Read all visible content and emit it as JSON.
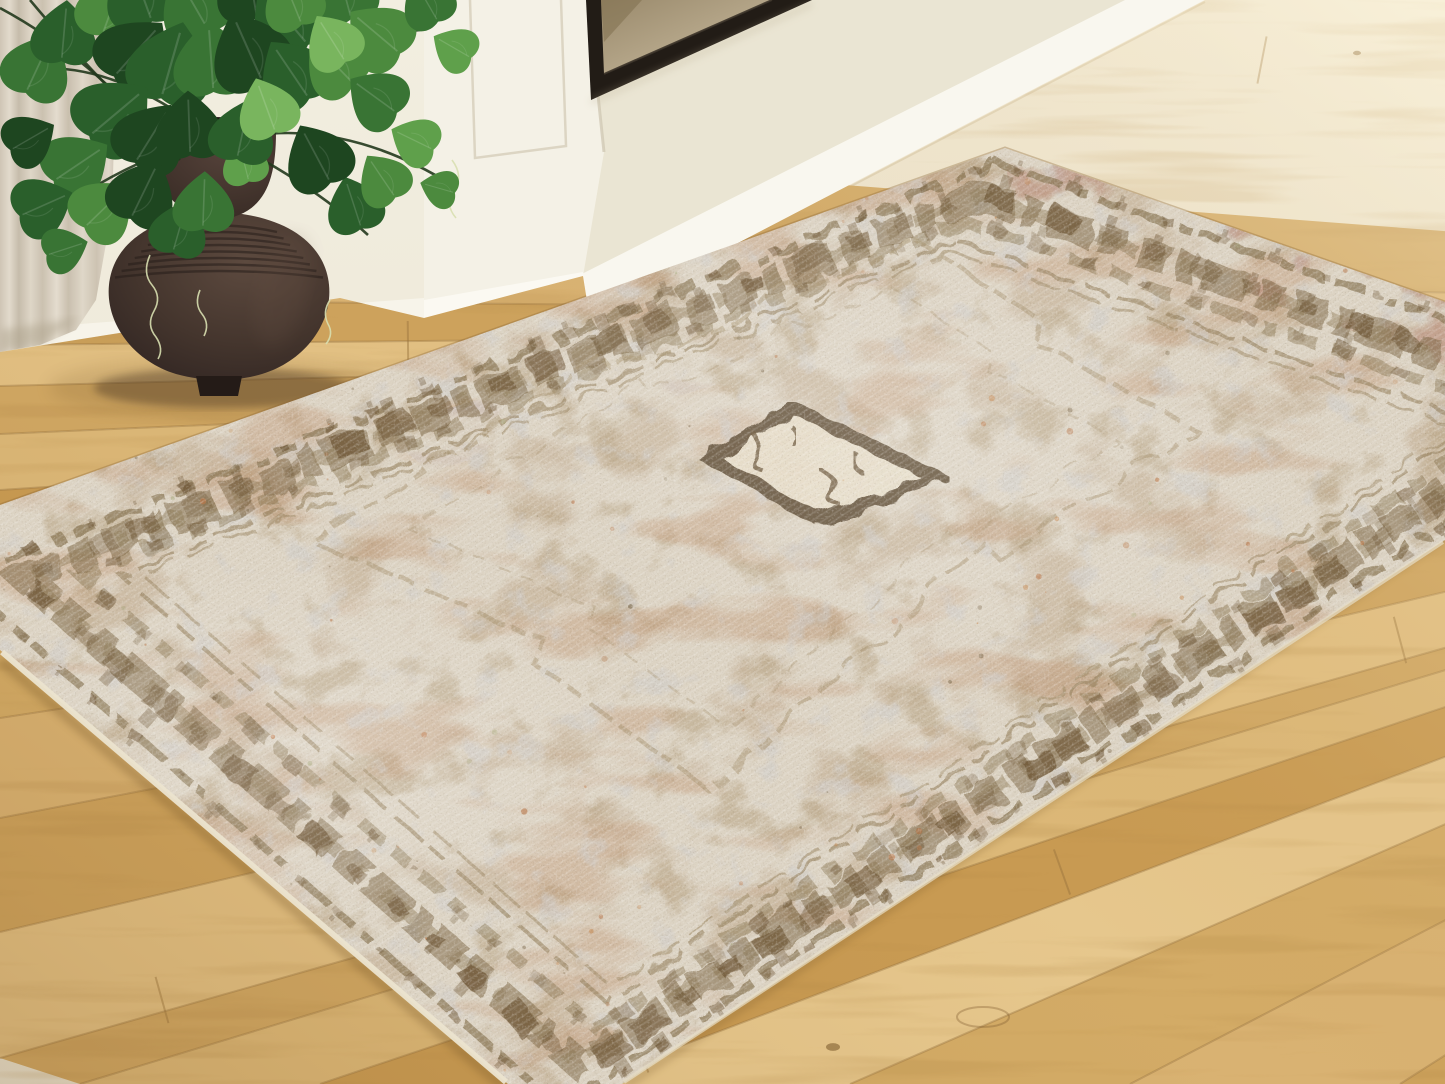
{
  "scene": {
    "kind": "room-photo",
    "subject": "distressed vintage medallion area rug on light oak hardwood floor",
    "props": [
      "white fireplace surround",
      "framed bronze artwork",
      "beige linen curtain",
      "dark brown gourd vase",
      "trailing pothos plant"
    ]
  },
  "palette": {
    "wallTop": "#f2eee0",
    "wallBottom": "#e9e3d1",
    "surround": "#eae5d3",
    "bandWhite": "#f9f7ef",
    "pillar": "#f4f1e6",
    "pillarEdge": "#d9d2bf",
    "baseboard": "#f7f4ea",
    "frame": "#221c16",
    "frameLip": "#3d352b",
    "canvasA": "#9a8a6c",
    "canvasB": "#b3a487",
    "canvasC": "#80704f",
    "curtainA": "#d9d0c1",
    "curtainB": "#c6bcab",
    "curtainC": "#e4dcce",
    "floorLight": "#e4c68c",
    "floorMid": "#d5ab66",
    "floorDark": "#c3924c",
    "seam": "#96713c",
    "knot": "#7c5a2e",
    "floorStreak": "#b08645",
    "shadow": "#6e4f23",
    "rugBase": "#dcd3c3",
    "rugTaupe": "#c7b49b",
    "rugTan": "#b5a07f",
    "rugRust": "#bb8a63",
    "rugGray": "#cfccc9",
    "rugPink": "#c09384",
    "rugLavender": "#cbc4c6",
    "borderDark": "#79643f",
    "borderMid": "#8d7956",
    "motif": "#6f5939",
    "lineThin": "#97825f",
    "fieldLine": "#a5906c",
    "medallionFill": "#e7ddc8",
    "medallionEdge": "#5f4d35",
    "medallionInk": "#6b5438",
    "binding": "#ece4cf",
    "vaseDark": "#372a24",
    "vaseMid": "#4a3a31",
    "vaseLight": "#5d4a3f",
    "vaseRib": "#271e19",
    "leafColors": [
      "#1e4620",
      "#2a5f2b",
      "#397434",
      "#4c8a3e",
      "#5fa04b",
      "#79b55e"
    ],
    "stem": "#22391d",
    "tendril": "#d8dfb0",
    "speckleRust": [
      "#bf7a4a",
      "#c78d58",
      "#b56f3f"
    ],
    "speckleSage": [
      "#9fa06f",
      "#b0b184"
    ],
    "speckleDark": "#6a5535"
  },
  "wall": {
    "floorBoundary": [
      [
        0,
        352
      ],
      [
        340,
        298
      ],
      [
        424,
        318
      ],
      [
        583,
        276
      ],
      [
        590,
        320
      ],
      [
        1205,
        0
      ]
    ],
    "surroundPoly": [
      [
        588,
        0
      ],
      [
        1128,
        0
      ],
      [
        560,
        285
      ],
      [
        583,
        276
      ],
      [
        604,
        152
      ]
    ],
    "bandPoly": [
      [
        560,
        285
      ],
      [
        1125,
        0
      ],
      [
        1205,
        0
      ],
      [
        590,
        320
      ]
    ],
    "leftBasePoly": [
      [
        0,
        330
      ],
      [
        424,
        298
      ],
      [
        424,
        318
      ],
      [
        0,
        352
      ]
    ],
    "pillarPoly": [
      [
        424,
        0
      ],
      [
        588,
        0
      ],
      [
        604,
        152
      ],
      [
        583,
        276
      ],
      [
        424,
        318
      ]
    ],
    "pillarBasePoly": [
      [
        424,
        300
      ],
      [
        583,
        272
      ],
      [
        586,
        286
      ],
      [
        424,
        322
      ]
    ],
    "panelLine": "M470,0 L475,158 L566,146 L561,0"
  },
  "artwork": {
    "framePoly": [
      [
        586,
        0
      ],
      [
        812,
        0
      ],
      [
        591,
        100
      ]
    ],
    "canvasPoly": [
      [
        601,
        0
      ],
      [
        772,
        0
      ],
      [
        604,
        74
      ]
    ],
    "shadePoly": [
      [
        601,
        0
      ],
      [
        642,
        0
      ],
      [
        604,
        42
      ]
    ]
  },
  "curtain": {
    "poly": [
      [
        0,
        0
      ],
      [
        118,
        0
      ],
      [
        112,
        210
      ],
      [
        96,
        300
      ],
      [
        76,
        330
      ],
      [
        40,
        345
      ],
      [
        0,
        352
      ]
    ]
  },
  "floor": {
    "clip": [
      [
        0,
        352
      ],
      [
        340,
        298
      ],
      [
        424,
        318
      ],
      [
        583,
        276
      ],
      [
        590,
        320
      ],
      [
        1205,
        0
      ],
      [
        1445,
        0
      ],
      [
        1445,
        1084
      ],
      [
        0,
        1084
      ]
    ],
    "vp": [
      2600,
      320
    ],
    "leftAnchors": [
      258,
      300,
      345,
      386,
      434,
      490,
      556,
      632,
      718,
      818,
      932,
      1058
    ],
    "bottomAnchors": [
      80,
      320,
      580,
      850,
      1130,
      1400
    ],
    "plankColors": [
      "#d9b272",
      "#cda25c",
      "#e2c083",
      "#d0a763",
      "#dcb878",
      "#c89a52",
      "#e6c78d",
      "#d3ab66"
    ],
    "joints": [
      [
        1262,
        60
      ],
      [
        408,
        345
      ],
      [
        1062,
        872
      ],
      [
        162,
        1000
      ],
      [
        1400,
        640
      ],
      [
        880,
        262
      ],
      [
        640,
        1050
      ]
    ],
    "knots": [
      [
        833,
        1047,
        7
      ],
      [
        1357,
        53,
        4
      ],
      [
        700,
        915,
        5
      ]
    ],
    "swirl": [
      983,
      1017
    ]
  },
  "rug": {
    "clip": [
      [
        1005,
        148
      ],
      [
        1445,
        302
      ],
      [
        1445,
        540
      ],
      [
        622,
        1084
      ],
      [
        508,
        1084
      ],
      [
        0,
        650
      ],
      [
        0,
        505
      ]
    ],
    "quad": [
      [
        1005,
        148
      ],
      [
        1681,
        384
      ],
      [
        552,
        1130
      ],
      [
        -74,
        580
      ]
    ],
    "center": [
      791,
      560
    ],
    "insets": {
      "guard": 0.962,
      "bandMain": 0.885,
      "bandOver": 0.885,
      "band2": 0.82,
      "line1": 0.775,
      "line2": 0.75
    },
    "pinkEdge": [
      [
        1005,
        148
      ],
      [
        1445,
        302
      ],
      [
        1445,
        365
      ],
      [
        1010,
        205
      ]
    ],
    "lavenderStreak": [
      [
        380,
        430
      ],
      [
        700,
        330
      ],
      [
        790,
        362
      ],
      [
        430,
        472
      ]
    ],
    "fieldOutline": "M915,240 L1040,320 L1028,338 L1195,428 L1000,560 L985,545 L705,788 L530,660 L545,640 L312,542 L600,355 L615,372 Z",
    "medallion": [
      [
        793,
        408
      ],
      [
        938,
        478
      ],
      [
        818,
        520
      ],
      [
        710,
        458
      ]
    ],
    "medallionInk": [
      "M752,432 q16,14 4,24 q-10,9 8,16",
      "M820,470 q18,6 10,20 q-8,12 10,14",
      "M856,452 q-6,16 8,22",
      "M790,425 q10,10 2,20"
    ],
    "bindingBL": [
      [
        2,
        652
      ],
      [
        506,
        1082
      ]
    ],
    "bindingBR": [
      [
        624,
        1082
      ],
      [
        1443,
        542
      ]
    ],
    "speckles": {
      "rust": 95,
      "sage": 28,
      "dark": 45,
      "seed": 12
    },
    "motifSeed": 5
  },
  "vase": {
    "cup": "M150,128 C150,185 172,215 218,220 C262,215 276,186 276,132 C240,146 186,146 150,128 Z",
    "mouth": [
      213,
      130,
      63,
      13
    ],
    "bulb": "M219,212 C160,214 118,238 110,278 C102,318 130,360 176,374 C205,382 235,382 262,374 C308,360 336,318 328,278 C320,238 278,214 219,212 Z",
    "foot": "M196,376 L242,376 L238,396 L200,396 Z",
    "ribs": {
      "cx": 219,
      "yTop": 224,
      "step": 6.5,
      "count": 8,
      "wStart": 58,
      "wEnd": 104
    },
    "shadow": [
      222,
      388,
      128,
      20
    ]
  },
  "plant": {
    "stems": [
      "M215,138 C150,90 90,60 20,70",
      "M220,135 C260,70 330,40 420,30",
      "M210,140 C160,150 90,180 30,235",
      "M225,142 C300,120 380,140 452,185",
      "M205,135 C180,95 150,60 120,45",
      "M222,140 C270,160 330,200 368,235",
      "M0,8 C60,40 120,90 168,150",
      "M30,0 C80,60 130,110 180,160"
    ],
    "tendrils": [
      "M150,255 q-8,18 2,30 q10,12 2,26 q-8,14 2,26 q8,12 2,22",
      "M200,290 q-6,14 2,24 q8,10 2,22",
      "M452,160 q12,16 2,30 q-10,14 2,28",
      "M330,300 q-8,12 -2,24 q6,10 -2,20"
    ],
    "leaves": [
      [
        28,
        88,
        205,
        0.9,
        2
      ],
      [
        62,
        56,
        185,
        0.85,
        1
      ],
      [
        104,
        30,
        200,
        0.9,
        3
      ],
      [
        150,
        16,
        160,
        1.0,
        1
      ],
      [
        206,
        26,
        150,
        0.95,
        2
      ],
      [
        256,
        12,
        170,
        0.95,
        0
      ],
      [
        304,
        40,
        140,
        1.05,
        1
      ],
      [
        350,
        14,
        165,
        0.85,
        2
      ],
      [
        396,
        50,
        130,
        0.9,
        3
      ],
      [
        436,
        18,
        150,
        0.7,
        2
      ],
      [
        468,
        56,
        120,
        0.6,
        4
      ],
      [
        118,
        72,
        222,
        1.0,
        0
      ],
      [
        163,
        92,
        196,
        1.1,
        1
      ],
      [
        213,
        86,
        176,
        1.0,
        2
      ],
      [
        260,
        76,
        156,
        1.05,
        0
      ],
      [
        306,
        94,
        146,
        0.95,
        1
      ],
      [
        350,
        80,
        136,
        0.85,
        3
      ],
      [
        393,
        110,
        126,
        0.8,
        2
      ],
      [
        430,
        148,
        116,
        0.65,
        4
      ],
      [
        452,
        192,
        106,
        0.5,
        3
      ],
      [
        94,
        132,
        230,
        1.05,
        1
      ],
      [
        138,
        158,
        212,
        0.95,
        0
      ],
      [
        58,
        178,
        236,
        0.9,
        2
      ],
      [
        24,
        214,
        246,
        0.8,
        1
      ],
      [
        88,
        224,
        226,
        0.85,
        3
      ],
      [
        133,
        214,
        206,
        0.9,
        0
      ],
      [
        50,
        254,
        252,
        0.6,
        2
      ],
      [
        14,
        148,
        240,
        0.7,
        0
      ],
      [
        174,
        248,
        196,
        0.75,
        1
      ],
      [
        203,
        224,
        182,
        0.8,
        2
      ],
      [
        360,
        224,
        162,
        0.75,
        1
      ],
      [
        393,
        194,
        146,
        0.7,
        3
      ],
      [
        328,
        178,
        152,
        0.9,
        0
      ],
      [
        248,
        178,
        166,
        0.6,
        4
      ],
      [
        190,
        150,
        178,
        0.9,
        0
      ],
      [
        238,
        154,
        192,
        0.85,
        1
      ],
      [
        300,
        20,
        158,
        0.8,
        3
      ],
      [
        343,
        58,
        148,
        0.75,
        5
      ],
      [
        274,
        128,
        160,
        0.8,
        5
      ]
    ]
  }
}
